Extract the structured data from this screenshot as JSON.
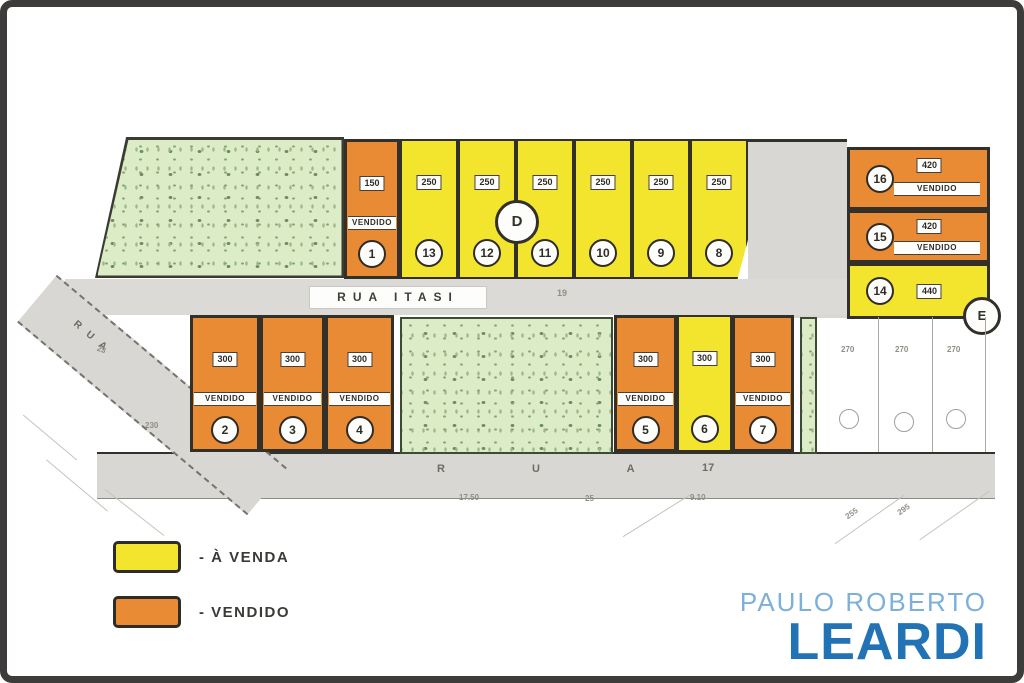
{
  "labels": {
    "vendido": "VENDIDO"
  },
  "streets": {
    "itasi": "RUA ITASI",
    "itasi_side_number": "19",
    "bottom_name": "R U A",
    "bottom_number": "17",
    "left_name": "RUA"
  },
  "markers": {
    "d": "D",
    "e": "E"
  },
  "lots": {
    "top_row": [
      {
        "number": "1",
        "area": "150",
        "status": "vendido"
      },
      {
        "number": "13",
        "area": "250",
        "status": "a_venda"
      },
      {
        "number": "12",
        "area": "250",
        "status": "a_venda"
      },
      {
        "number": "11",
        "area": "250",
        "status": "a_venda"
      },
      {
        "number": "10",
        "area": "250",
        "status": "a_venda"
      },
      {
        "number": "9",
        "area": "250",
        "status": "a_venda"
      },
      {
        "number": "8",
        "area": "250",
        "status": "a_venda"
      }
    ],
    "right_block": [
      {
        "number": "16",
        "area": "420",
        "status": "vendido"
      },
      {
        "number": "15",
        "area": "420",
        "status": "vendido"
      },
      {
        "number": "14",
        "area": "440",
        "status": "a_venda"
      }
    ],
    "bottom_left": [
      {
        "number": "2",
        "area": "300",
        "status": "vendido"
      },
      {
        "number": "3",
        "area": "300",
        "status": "vendido"
      },
      {
        "number": "4",
        "area": "300",
        "status": "vendido"
      }
    ],
    "bottom_middle": [
      {
        "number": "5",
        "area": "300",
        "status": "vendido"
      },
      {
        "number": "6",
        "area": "300",
        "status": "a_venda"
      },
      {
        "number": "7",
        "area": "300",
        "status": "vendido"
      }
    ]
  },
  "faint": {
    "right_lot_areas": [
      "270",
      "270",
      "270"
    ],
    "bottom_marks": [
      "17.50",
      "25",
      "9.10"
    ],
    "left_marks": [
      "23",
      "230"
    ],
    "right_marks": [
      "255",
      "295"
    ]
  },
  "legend": {
    "items": [
      {
        "label": "- À VENDA",
        "color": "#f3e52e"
      },
      {
        "label": "- VENDIDO",
        "color": "#e98a35"
      }
    ]
  },
  "logo": {
    "line1": "PAULO ROBERTO",
    "line2": "LEARDI",
    "line1_color": "#7cb0da",
    "line2_color": "#2273b5"
  }
}
